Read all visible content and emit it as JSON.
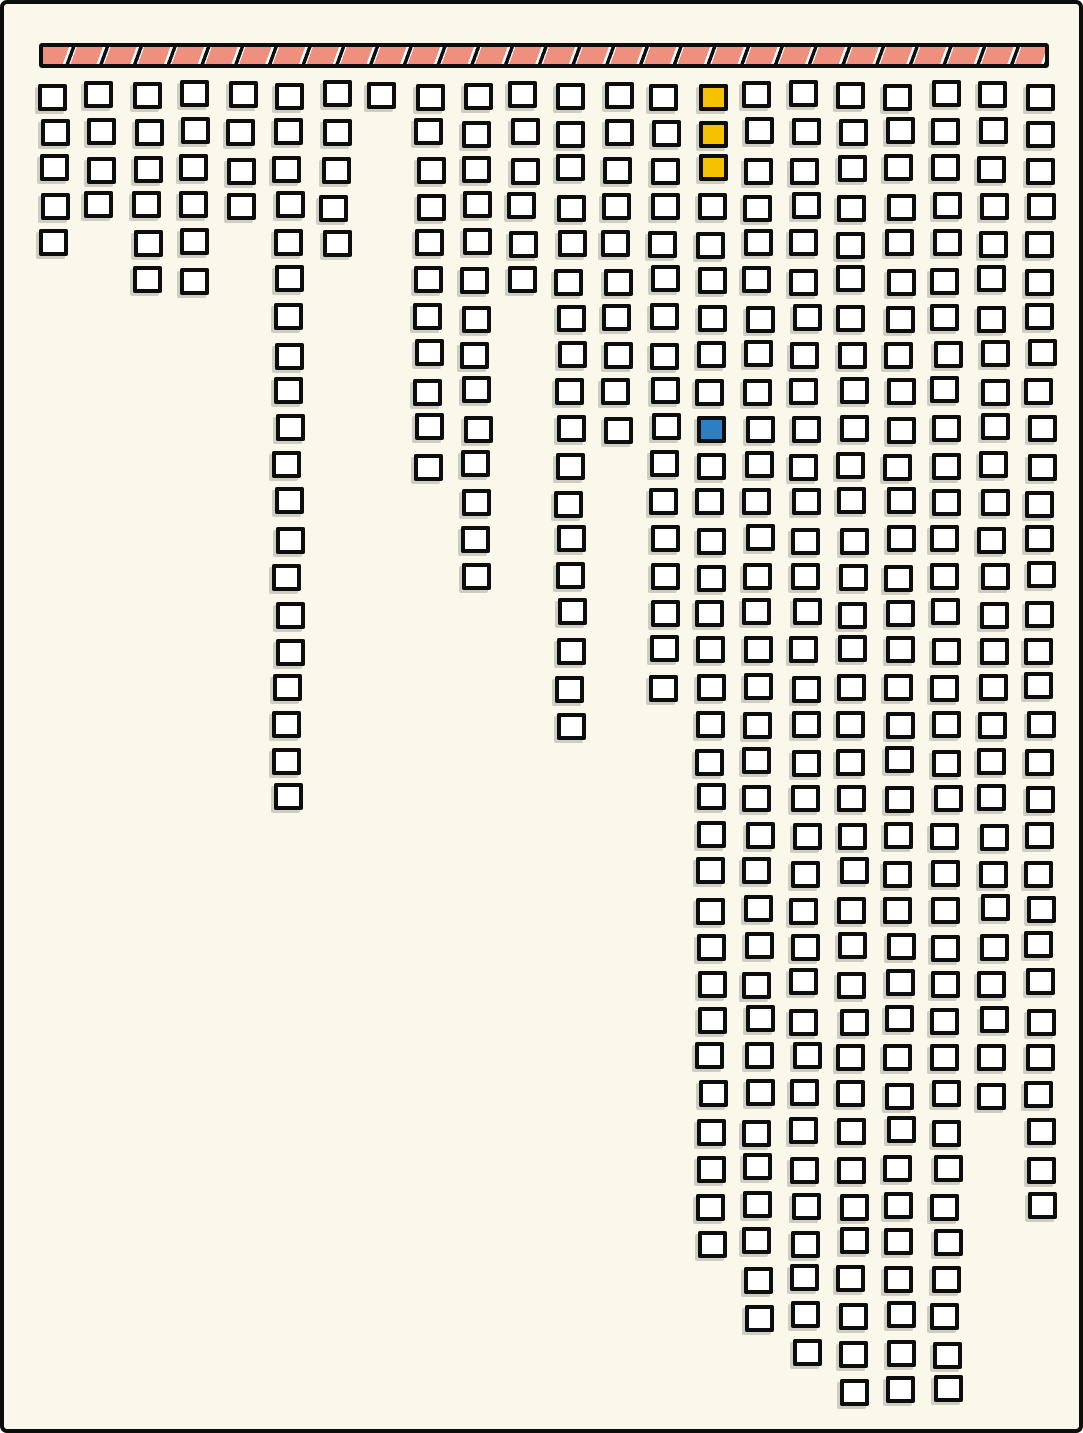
{
  "colors": {
    "ink": "#0d0d0d",
    "background_cream": "#faf8eb",
    "cell_fill": "#ffffff",
    "cell_shadow": "rgba(105,105,95,0.30)",
    "highlight_yellow": "#f7c103",
    "highlight_blue": "#2e7fc2",
    "rail_salmon": "#ef8f7e",
    "rail_gap_white": "#ffffff"
  },
  "top_bar": {
    "hatch_segments": 30,
    "fill": "#ef8f7e"
  },
  "chart_data": {
    "type": "unit_grid_pictograph",
    "title": "",
    "orientation": "columns_hanging_from_top_rail",
    "grid": false,
    "legend": false,
    "column_count": 22,
    "max_rows": 36,
    "categories": [
      1,
      2,
      3,
      4,
      5,
      6,
      7,
      8,
      9,
      10,
      11,
      12,
      13,
      14,
      15,
      16,
      17,
      18,
      19,
      20,
      21,
      22
    ],
    "values": [
      5,
      4,
      6,
      6,
      4,
      20,
      5,
      1,
      11,
      14,
      6,
      18,
      10,
      17,
      32,
      34,
      35,
      36,
      36,
      36,
      28,
      31
    ],
    "highlighted_cells": [
      {
        "column": 15,
        "row": 1,
        "color": "highlight_yellow"
      },
      {
        "column": 15,
        "row": 2,
        "color": "highlight_yellow"
      },
      {
        "column": 15,
        "row": 3,
        "color": "highlight_yellow"
      },
      {
        "column": 15,
        "row": 10,
        "color": "highlight_blue"
      }
    ]
  }
}
